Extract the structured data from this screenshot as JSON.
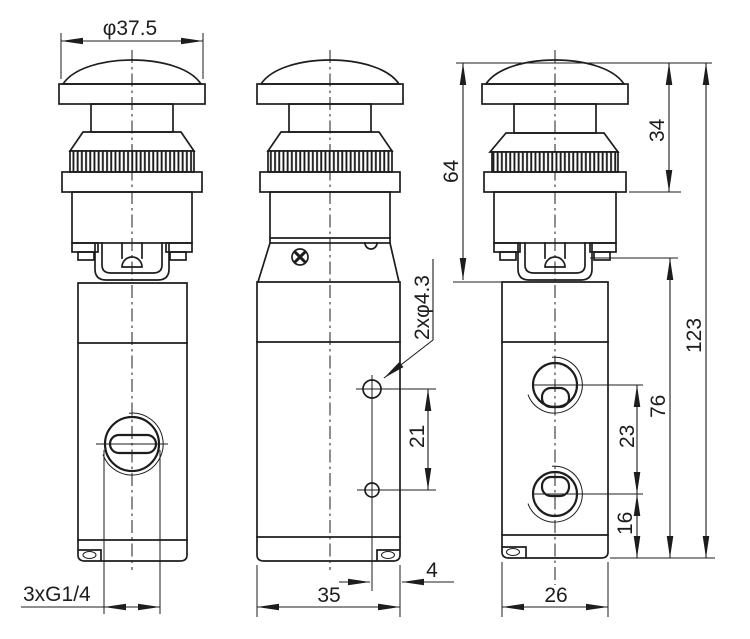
{
  "drawing": {
    "background": "#ffffff",
    "line_color": "#1d1d1d",
    "dimensions": {
      "cap_diameter": "φ37.5",
      "port_thread": "3xG1/4",
      "front_width": "35",
      "hole_to_edge": "4",
      "hole_spacing": "21",
      "mount_holes": "2xφ4.3",
      "actuator_height": "64",
      "button_height": "34",
      "overall_height": "123",
      "body_height": "76",
      "port_spacing": "23",
      "port_to_base": "16",
      "side_width": "26"
    }
  }
}
